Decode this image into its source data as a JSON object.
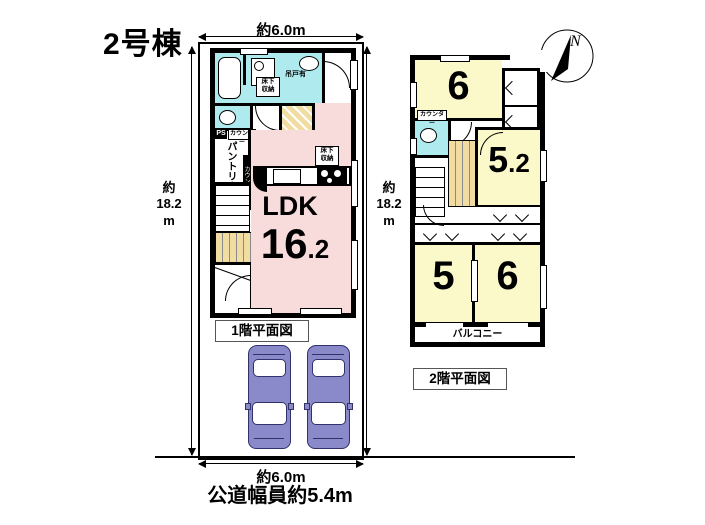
{
  "title": "2号棟",
  "dims": {
    "top": "約6.0m",
    "left": "約\n18.2\nm",
    "right": "約\n18.2\nm",
    "bottom": "約6.0m",
    "road": "公道幅員約5.4m"
  },
  "f1": {
    "caption": "1階平面図",
    "ldk_label": "LDK",
    "ldk_int": "16",
    "ldk_dec": ".2",
    "storage": "床下\n収納",
    "hanging": "吊戸有",
    "ps": "PS",
    "counter": "カウンター",
    "counter2": "カウンター",
    "pantry": "パントリー"
  },
  "f2": {
    "caption": "2階平面図",
    "rooms": [
      {
        "name": "north-bedroom",
        "int": "6",
        "dec": ""
      },
      {
        "name": "east-bedroom",
        "int": "5",
        "dec": ".2"
      },
      {
        "name": "southwest-bedroom",
        "int": "5",
        "dec": ""
      },
      {
        "name": "southeast-bedroom",
        "int": "6",
        "dec": ""
      }
    ],
    "balcony": "バルコニー",
    "counter": "カウンター",
    "compass_n": "N"
  },
  "colors": {
    "ldk_pink": "#F8DBDB",
    "room_yellow": "#FBF9C9",
    "water_cyan": "#AFEAEF",
    "stairs_tan": "#F1DCA2",
    "car_body": "#8A8ACA",
    "wall": "#000000"
  }
}
